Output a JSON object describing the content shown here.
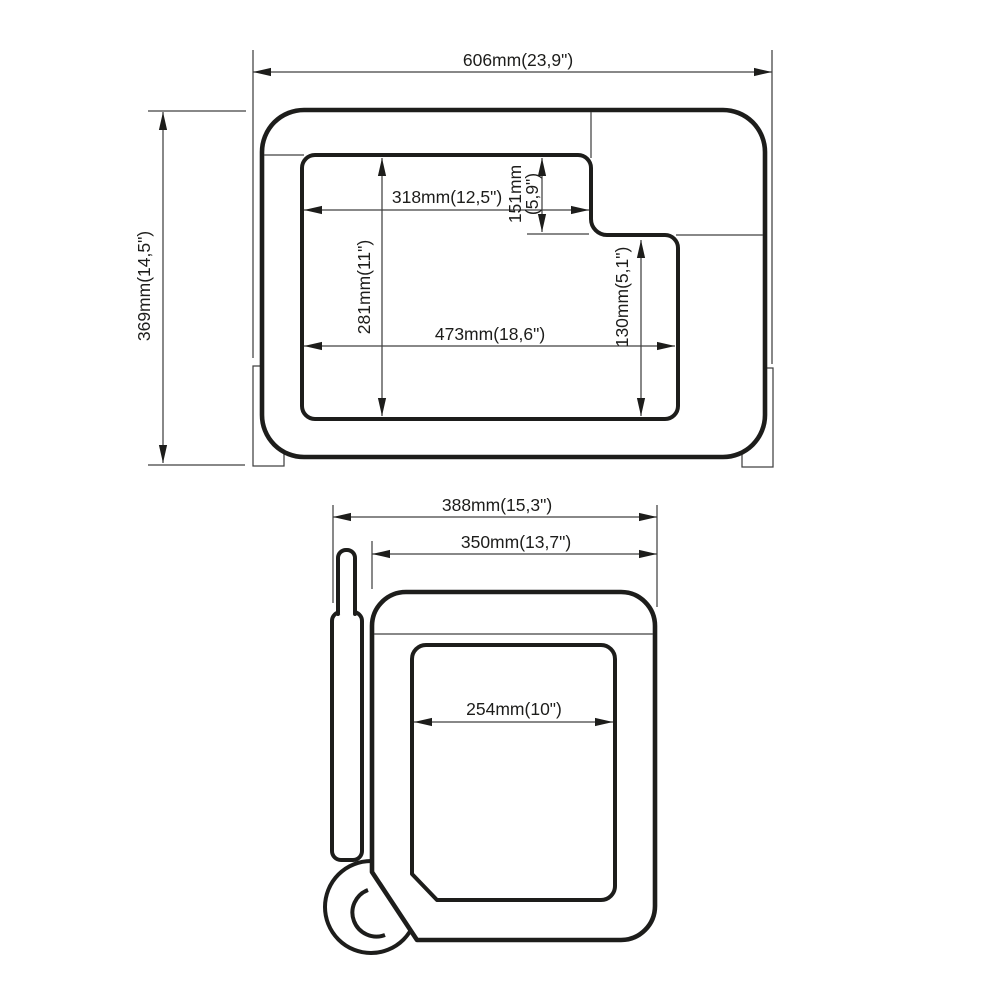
{
  "drawing": {
    "type": "technical-dimension-drawing",
    "colors": {
      "line": "#1d1d1b",
      "thin_line": "#424242",
      "background": "#ffffff"
    },
    "top_view": {
      "dimensions": {
        "outer_width": "606mm(23,9\")",
        "outer_height": "369mm(14,5\")",
        "lid_top_width": "318mm(12,5\")",
        "notch_height_line1": "151mm",
        "notch_height_line2": "(5,9\")",
        "opening_depth_left": "281mm(11\")",
        "opening_full_width": "473mm(18,6\")",
        "opening_depth_right": "130mm(5,1\")"
      }
    },
    "side_view": {
      "dimensions": {
        "total_width_with_handle": "388mm(15,3\")",
        "body_width": "350mm(13,7\")",
        "opening_width": "254mm(10\")"
      }
    }
  }
}
